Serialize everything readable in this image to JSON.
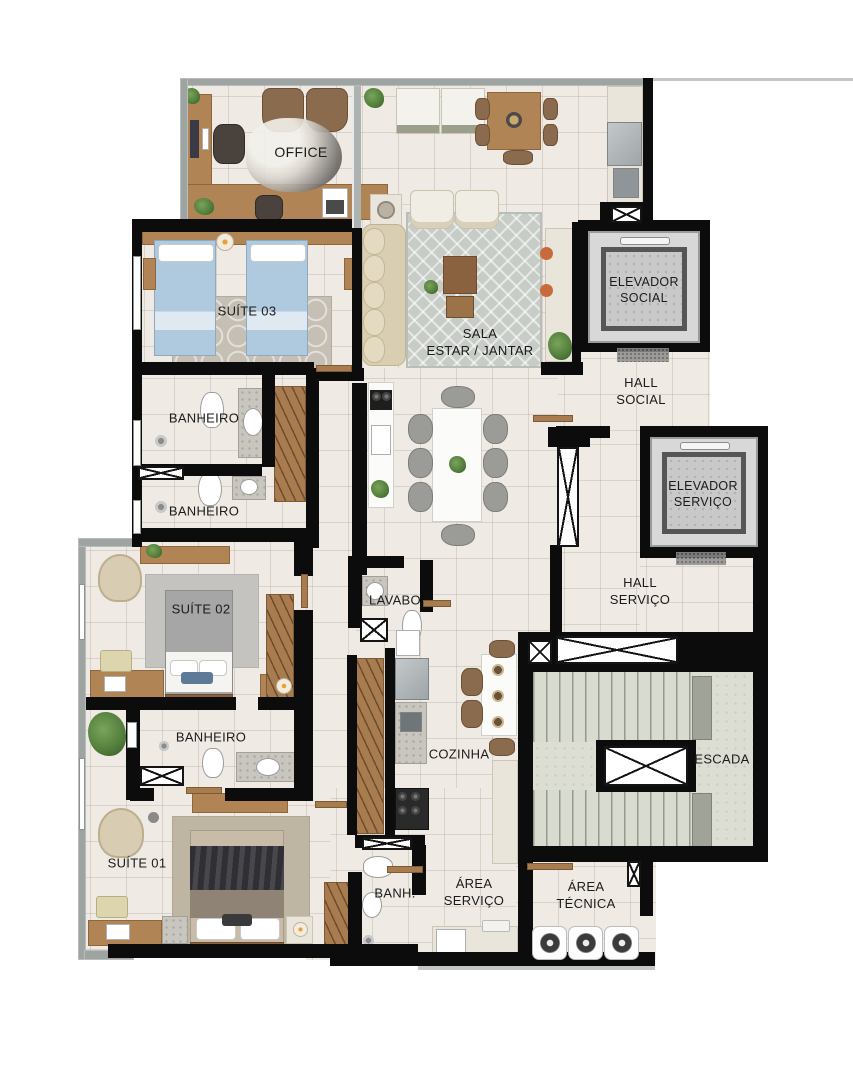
{
  "plan": {
    "type": "apartment-floor-plan",
    "rooms": {
      "office": "OFFICE",
      "suite03": "SUÍTE 03",
      "sala": "SALA\nESTAR / JANTAR",
      "elevador_social": "ELEVADOR\nSOCIAL",
      "hall_social": "HALL\nSOCIAL",
      "banheiro_top": "BANHEIRO",
      "banheiro_mid": "BANHEIRO",
      "elevador_servico": "ELEVADOR\nSERVIÇO",
      "hall_servico": "HALL\nSERVIÇO",
      "suite02": "SUÍTE 02",
      "lavabo": "LAVABO",
      "banheiro_suite01": "BANHEIRO",
      "cozinha": "COZINHA",
      "escada": "ESCADA",
      "suite01": "SUÍTE 01",
      "banh": "BANH.",
      "area_servico": "ÁREA\nSERVIÇO",
      "area_tecnica": "ÁREA\nTÉCNICA"
    },
    "colors": {
      "background": "#FFFFFF",
      "floor": "#EFEAE4",
      "wall": "#0C0C0C",
      "outer_wall": "#9EA4A2",
      "wood": "#B08455",
      "stairs": "#D8DBCF",
      "elevator": "#C9C9C9",
      "rug": "#C7CCC6",
      "bed_blue": "#AFC9DE",
      "label_text": "#1B1B1B"
    }
  }
}
